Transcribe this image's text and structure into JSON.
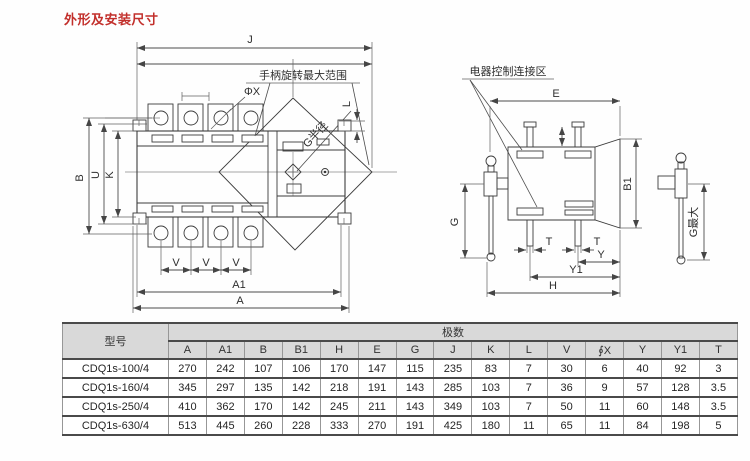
{
  "page": {
    "title": "外形及安装尺寸"
  },
  "front_view": {
    "dim_j": "J",
    "handle_range_label": "手柄旋转最大范围",
    "phi_x": "ΦX",
    "g_radius": "G半径",
    "dim_l": "L",
    "dim_b": "B",
    "dim_u": "U",
    "dim_k": "K",
    "dim_v": "V",
    "dim_a1": "A1",
    "dim_a": "A"
  },
  "side_view": {
    "control_area_label": "电器控制连接区",
    "dim_e": "E",
    "dim_b1": "B1",
    "dim_g": "G",
    "dim_t": "T",
    "dim_y": "Y",
    "dim_y1": "Y1",
    "dim_h": "H"
  },
  "handle_detail": {
    "g_max": "G最大"
  },
  "table": {
    "model_header": "型号",
    "poles_header": "极数",
    "columns": [
      "A",
      "A1",
      "B",
      "B1",
      "H",
      "E",
      "G",
      "J",
      "K",
      "L",
      "V",
      "∮X",
      "Y",
      "Y1",
      "T"
    ],
    "rows": [
      {
        "model": "CDQ1s-100/4",
        "values": [
          "270",
          "242",
          "107",
          "106",
          "170",
          "147",
          "115",
          "235",
          "83",
          "7",
          "30",
          "6",
          "40",
          "92",
          "3"
        ]
      },
      {
        "model": "CDQ1s-160/4",
        "values": [
          "345",
          "297",
          "135",
          "142",
          "218",
          "191",
          "143",
          "285",
          "103",
          "7",
          "36",
          "9",
          "57",
          "128",
          "3.5"
        ]
      },
      {
        "model": "CDQ1s-250/4",
        "values": [
          "410",
          "362",
          "170",
          "142",
          "245",
          "211",
          "143",
          "349",
          "103",
          "7",
          "50",
          "11",
          "60",
          "148",
          "3.5"
        ]
      },
      {
        "model": "CDQ1s-630/4",
        "values": [
          "513",
          "445",
          "260",
          "228",
          "333",
          "270",
          "191",
          "425",
          "180",
          "11",
          "65",
          "11",
          "84",
          "198",
          "5"
        ]
      }
    ]
  },
  "colors": {
    "title": "#c22f2b",
    "header_bg": "#d9d9d9",
    "line": "#3c3c3c"
  }
}
